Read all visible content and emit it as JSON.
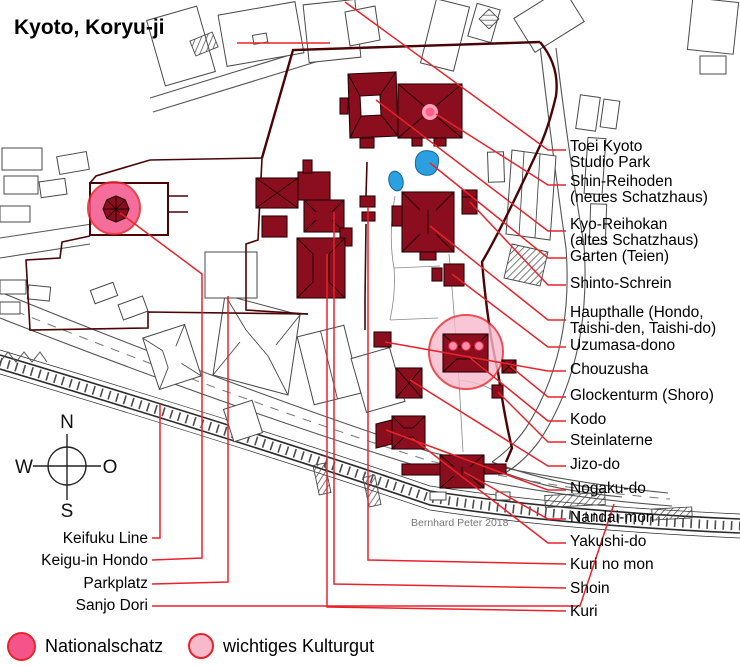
{
  "title": "Kyoto, Koryu-ji",
  "watermark": "Bernhard Peter 2018",
  "compass": {
    "n": "N",
    "e": "O",
    "s": "S",
    "w": "W"
  },
  "labels": {
    "right": [
      {
        "text": "Toei Kyoto\nStudio Park"
      },
      {
        "text": "Shin-Reihoden\n(neues Schatzhaus)"
      },
      {
        "text": "Kyo-Reihokan\n(altes Schatzhaus)"
      },
      {
        "text": "Garten (Teien)"
      },
      {
        "text": "Shinto-Schrein"
      },
      {
        "text": "Haupthalle (Hondo,\nTaishi-den, Taishi-do)"
      },
      {
        "text": "Uzumasa-dono"
      },
      {
        "text": "Chouzusha"
      },
      {
        "text": "Glockenturm (Shoro)"
      },
      {
        "text": "Kodo"
      },
      {
        "text": "Steinlaterne"
      },
      {
        "text": "Jizo-do"
      },
      {
        "text": "Nogaku-do"
      },
      {
        "text": "Nandai-mon"
      },
      {
        "text": "Yakushi-do"
      },
      {
        "text": "Kuri no mon"
      },
      {
        "text": "Shoin"
      },
      {
        "text": "Kuri"
      }
    ],
    "left": [
      {
        "text": "Keifuku Line"
      },
      {
        "text": "Keigu-in Hondo"
      },
      {
        "text": "Parkplatz"
      },
      {
        "text": "Sanjo Dori"
      }
    ]
  },
  "legend": {
    "national_treasure": "Nationalschatz",
    "important_cultural_property": "wichtiges Kulturgut"
  },
  "colors": {
    "building": "#8a0e1d",
    "wall": "#4a0406",
    "callout": "#e8232b",
    "ns_pink": "#f4548a",
    "kg_pink": "#f8b9cb",
    "pond": "#2b9fe0",
    "dot_pink": "#ff8fab"
  }
}
